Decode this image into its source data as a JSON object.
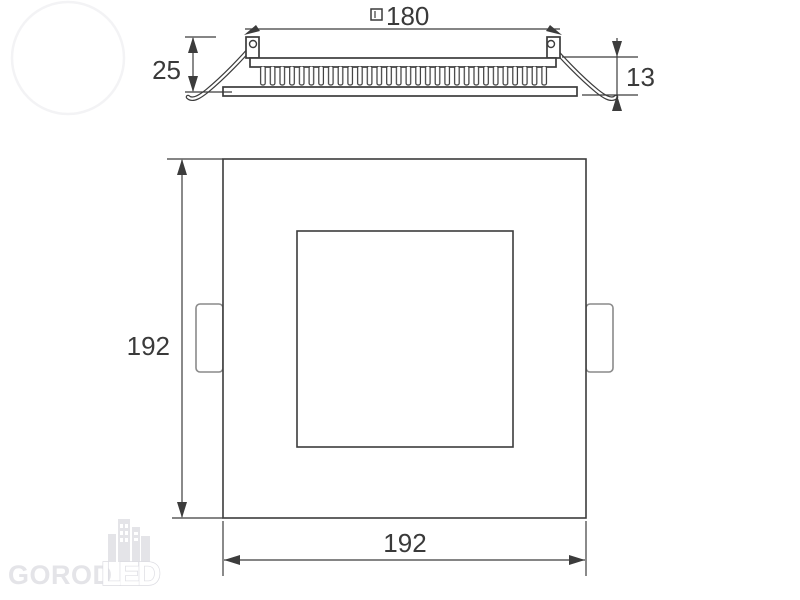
{
  "dimensions": {
    "cutout_width": "180",
    "recess_depth": "25",
    "profile_height": "13",
    "panel_height": "192",
    "panel_width": "192"
  },
  "watermark": {
    "primary": "GOROD",
    "accent": "LED"
  },
  "colors": {
    "line": "#3c3c3c",
    "dimension_text": "#3a3a3a",
    "tab_outline": "#8a8a8a",
    "watermark_gray": "#e4e4e8"
  }
}
